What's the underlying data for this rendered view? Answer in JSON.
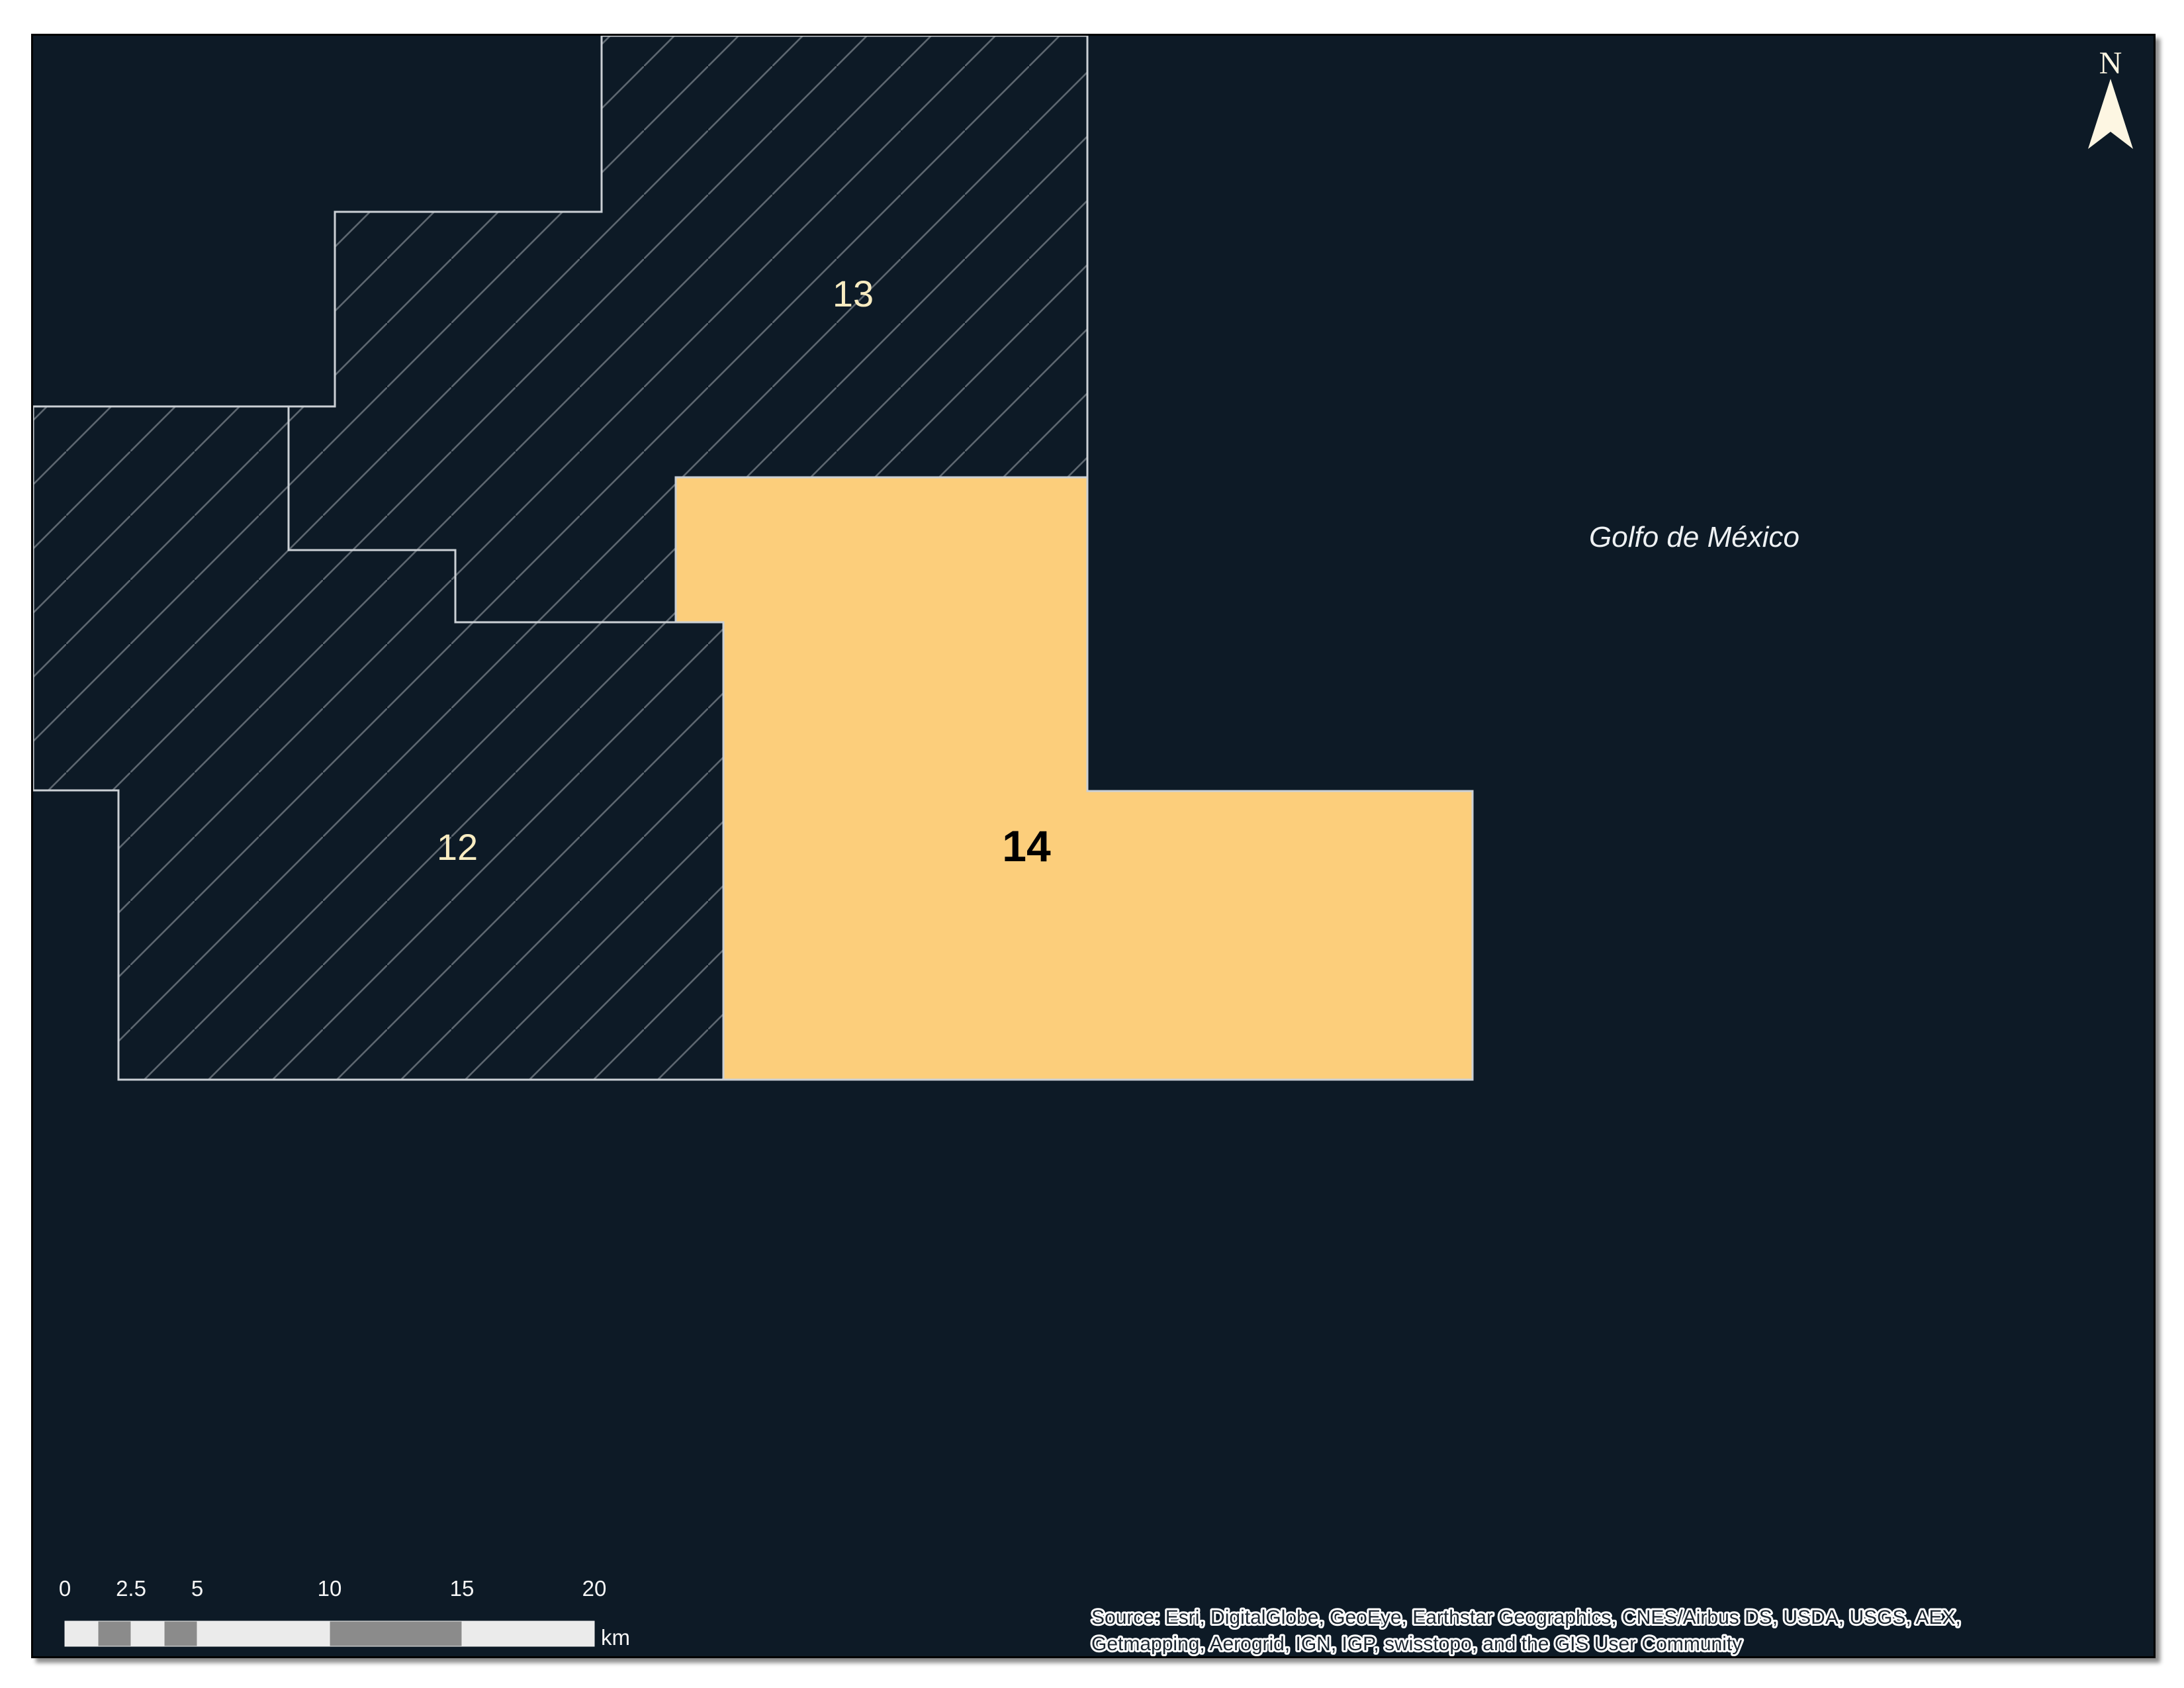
{
  "map": {
    "regions": [
      {
        "id": "12",
        "label": "12",
        "type": "hatched-block"
      },
      {
        "id": "13",
        "label": "13",
        "type": "hatched-block"
      },
      {
        "id": "14",
        "label": "14",
        "type": "highlighted-block"
      }
    ],
    "water_label": "Golfo de México"
  },
  "north_arrow": {
    "label": "N"
  },
  "scalebar": {
    "ticks": [
      "0",
      "2.5",
      "5",
      "10",
      "15",
      "20"
    ],
    "unit": "km"
  },
  "attribution": {
    "line1": "Source: Esri, DigitalGlobe, GeoEye, Earthstar Geographics, CNES/Airbus DS, USDA, USGS, AEX,",
    "line2": "Getmapping, Aerogrid, IGN, IGP, swisstopo, and the GIS User Community"
  },
  "colors": {
    "sea": "#0d1a26",
    "hatch_line": "#5d6770",
    "region_outline": "#cbd0d5",
    "region14_fill": "#fcce7b",
    "region_label_cream": "#f8ecc1",
    "region14_label": "#000000",
    "water_label_color": "#eef1f3",
    "north_arrow_color": "#fdf6e2",
    "scalebar_light": "#ebebeb",
    "scalebar_dark": "#8b8b8b",
    "scalebar_text": "#f5f5f5",
    "attribution_text": "#1c2630",
    "attribution_halo": "#ffffff"
  }
}
